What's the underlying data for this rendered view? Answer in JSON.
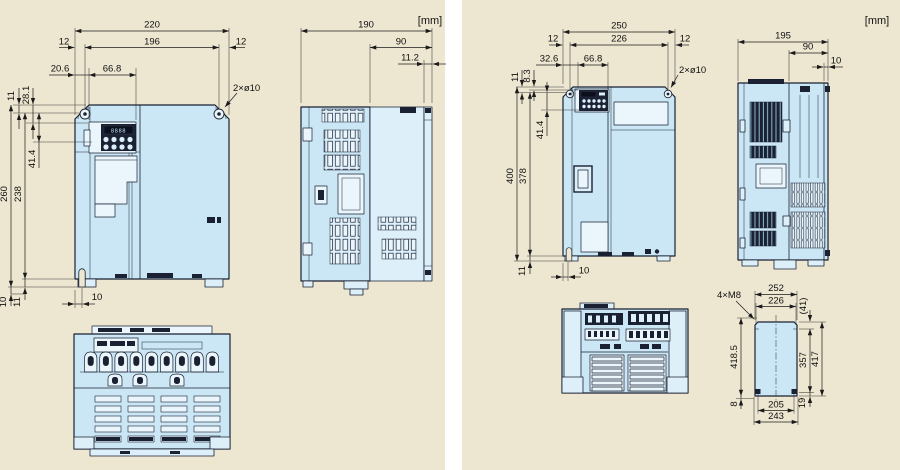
{
  "units_label": "[mm]",
  "left": {
    "front": {
      "w220": "220",
      "w196": "196",
      "d12l": "12",
      "d12r": "12",
      "k206": "20.6",
      "k668": "66.8",
      "v11": "11",
      "v281": "28.1",
      "h260": "260",
      "h238": "238",
      "v414": "41.4",
      "b10": "10",
      "b11": "11",
      "slot10": "10",
      "holes": "2×ø10",
      "display": "8888"
    },
    "side": {
      "d190": "190",
      "d90": "90",
      "d112": "11.2"
    }
  },
  "right": {
    "front": {
      "w250": "250",
      "w226": "226",
      "d12l": "12",
      "d12r": "12",
      "k326": "32.6",
      "k668": "66.8",
      "v11": "11",
      "v83": "8.3",
      "v414": "41.4",
      "h400": "400",
      "h378": "378",
      "b11": "11",
      "slot10": "10",
      "holes": "2×ø10"
    },
    "side": {
      "d195": "195",
      "d90": "90",
      "d10": "10"
    },
    "mount": {
      "bolts": "4×M8",
      "w252": "252",
      "w226": "226",
      "t41": "(41)",
      "h4185": "418.5",
      "h357": "357",
      "h417": "417",
      "b8": "8",
      "w205": "205",
      "b19": "19",
      "w243": "243"
    }
  }
}
